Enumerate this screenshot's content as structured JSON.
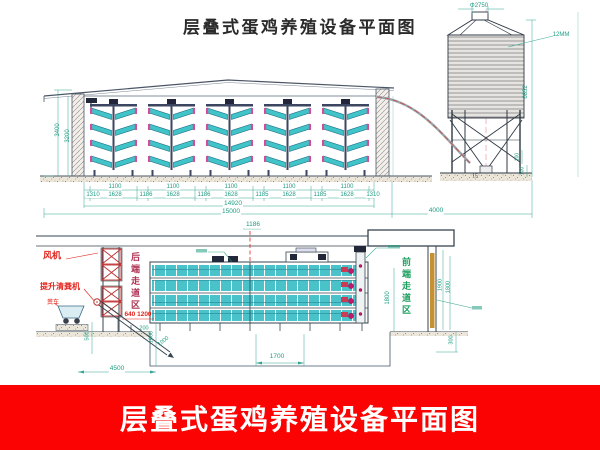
{
  "title": "层叠式蛋鸡养殖设备平面图",
  "banner": {
    "text": "层叠式蛋鸡养殖设备平面图",
    "bg_color": "#fa0302",
    "fg_color": "#ffffff"
  },
  "colors": {
    "dim_green": "#1f9c82",
    "label_red": "#e3241d",
    "cage_teal": "#41c4c8",
    "accent_pink": "#cf4f9b"
  },
  "upper_view": {
    "wall_height_outer": "3400",
    "wall_height_inner": "3200",
    "cage_width_labels": [
      "1100",
      "1100",
      "1100",
      "1100",
      "1100"
    ],
    "dim_chain": [
      "1310",
      "1628",
      "1186",
      "1628",
      "1186",
      "1628",
      "1185",
      "1628",
      "1185",
      "1628",
      "1310"
    ],
    "total_inner": "14920",
    "total_outer": "15000",
    "house_to_silo": "4000"
  },
  "silo": {
    "top_diameter": "Φ2750",
    "body_label": "12MM",
    "height": "6852",
    "leg_dim_top": "100",
    "leg_dim_bottom": "100",
    "base_mark": "15"
  },
  "lower_view": {
    "labels": {
      "fan": "风机",
      "manure_hoist": "提升清粪机",
      "manure_cart": "粪车",
      "rear_walkway": "后端走道区",
      "front_walkway": "前端走道区"
    },
    "dims": {
      "bay": "1186",
      "rear_door": "640 1200",
      "d200": "200",
      "d500": "500",
      "d1600": "1600",
      "d1000": "1000",
      "d4500": "4500",
      "d1700": "1700",
      "d1800": "1800",
      "d1900": "1900",
      "d1800b": "1800",
      "d300": "300"
    }
  }
}
